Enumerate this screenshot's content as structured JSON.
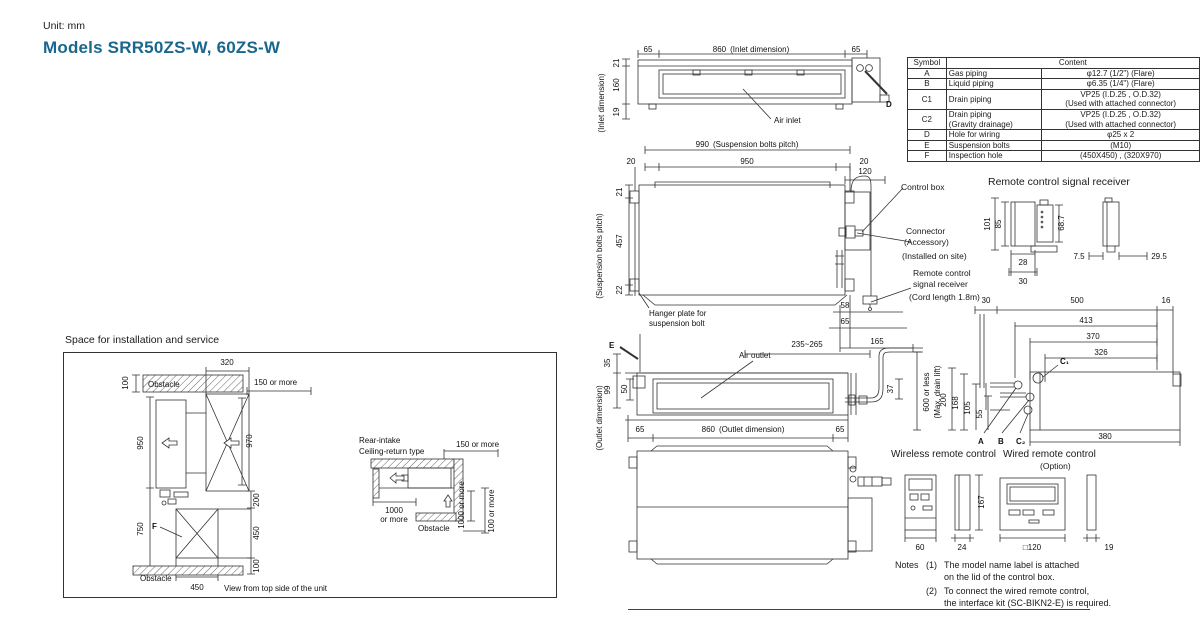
{
  "header": {
    "unit_label": "Unit: mm",
    "title": "Models SRR50ZS-W, 60ZS-W"
  },
  "colors": {
    "title_teal": "#19678d",
    "line": "#333333",
    "background": "#ffffff"
  },
  "symbol_table": {
    "col_symbol": "Symbol",
    "col_content": "Content",
    "rows": [
      {
        "symbol": "A",
        "item": "Gas piping",
        "val1": "φ12.7 (1/2\")  (Flare)"
      },
      {
        "symbol": "B",
        "item": "Liquid piping",
        "val1": "φ6.35 (1/4\")  (Flare)"
      },
      {
        "symbol": "C1",
        "item": "Drain piping",
        "val1": "VP25 (I.D.25 , O.D.32)",
        "val2": "(Used with attached connector)"
      },
      {
        "symbol": "C2",
        "item": "Drain piping",
        "item2": "(Gravity drainage)",
        "val1": "VP25 (I.D.25 , O.D.32)",
        "val2": "(Used with attached connector)"
      },
      {
        "symbol": "D",
        "item": "Hole for wiring",
        "val1": "φ25 x 2"
      },
      {
        "symbol": "E",
        "item": "Suspension bolts",
        "val1": "(M10)"
      },
      {
        "symbol": "F",
        "item": "Inspection hole",
        "val1": "(450X450) , (320X970)"
      }
    ]
  },
  "top_view": {
    "dim_65_left": "65",
    "dim_860": "860",
    "dim_860_note": "(Inlet dimension)",
    "dim_65_right": "65",
    "dim_21": "21",
    "dim_160": "160",
    "dim_19": "19",
    "axis_note": "(Inlet dimension)",
    "air_inlet_label": "Air inlet",
    "hole_label": "D"
  },
  "front_view": {
    "dim_990": "990",
    "dim_990_note": "(Suspension bolts pitch)",
    "dim_20_left": "20",
    "dim_950": "950",
    "dim_20_right": "20",
    "dim_120": "120",
    "dim_21": "21",
    "dim_457": "457",
    "dim_22": "22",
    "axis_note": "(Suspension bolts pitch)",
    "hanger_line1": "Hanger plate for",
    "hanger_line2": "suspension bolt",
    "control_box_label": "Control box",
    "connector_line1": "Connector",
    "connector_line2": "(Accessory)",
    "connector_line3": "(Installed on site)",
    "receiver_line1": "Remote control",
    "receiver_line2": "signal receiver",
    "receiver_line3": "(Cord length 1.8m)",
    "dim_58": "58",
    "dim_65": "65",
    "dim_165": "165"
  },
  "outlet_view": {
    "bolt_label": "E",
    "air_outlet_label": "Air outlet",
    "dim_35": "35",
    "dim_99": "99",
    "dim_50": "50",
    "dim_65_left": "65",
    "dim_860": "860",
    "dim_860_note": "(Outlet dimension)",
    "dim_65_right": "65",
    "axis_note": "(Outlet dimension)",
    "dim_235_265": "235~265",
    "dim_37": "37",
    "drain_line1": "600 or less",
    "drain_line2": "(Max. drain lift)"
  },
  "side_view": {
    "dim_30": "30",
    "dim_500": "500",
    "dim_16": "16",
    "dim_413": "413",
    "dim_370": "370",
    "dim_326": "326",
    "label_c1": "C₁",
    "dim_200": "200",
    "dim_168": "168",
    "dim_105": "105",
    "dim_55": "55",
    "label_a": "A",
    "label_b": "B",
    "label_c2": "C₂",
    "dim_380": "380"
  },
  "receiver_detail": {
    "title": "Remote control signal receiver",
    "dim_101": "101",
    "dim_85": "85",
    "dim_68_7": "68.7",
    "dim_28": "28",
    "dim_30": "30",
    "dim_7_5": "7.5",
    "dim_29_5": "29.5"
  },
  "remotes": {
    "wireless_title": "Wireless remote control",
    "wired_title": "Wired remote control",
    "wired_option": "(Option)",
    "dim_60": "60",
    "dim_24": "24",
    "dim_167": "167",
    "dim_120": "□120",
    "dim_19": "19"
  },
  "notes": {
    "label": "Notes",
    "note1_no": "(1)",
    "note1_line1": "The model name label is attached",
    "note1_line2": "on the lid of the control box.",
    "note2_no": "(2)",
    "note2_line1": "To connect the wired remote control,",
    "note2_line2": "the interface kit (SC-BIKN2-E) is required."
  },
  "installation": {
    "title": "Space for installation and service",
    "dim_320": "320",
    "dim_100_top": "100",
    "obstacle_top": "Obstacle",
    "dim_150_left": "150 or more",
    "dim_950": "950",
    "dim_970": "970",
    "dim_750": "750",
    "label_f": "F",
    "dim_200": "200",
    "dim_450_right": "450",
    "dim_100_bottom": "100",
    "dim_450_bottom": "450",
    "obstacle_bottom": "Obstacle",
    "caption": "View from top side of the unit",
    "rear_line1": "Rear-intake",
    "rear_line2": "Ceiling-return type",
    "dim_150_right": "150 or more",
    "dim_1000_left": "1000",
    "dim_1000_left2": "or more",
    "dim_1000_rot": "1000 or more",
    "dim_100_rot": "100 or more",
    "obstacle_right": "Obstacle"
  }
}
